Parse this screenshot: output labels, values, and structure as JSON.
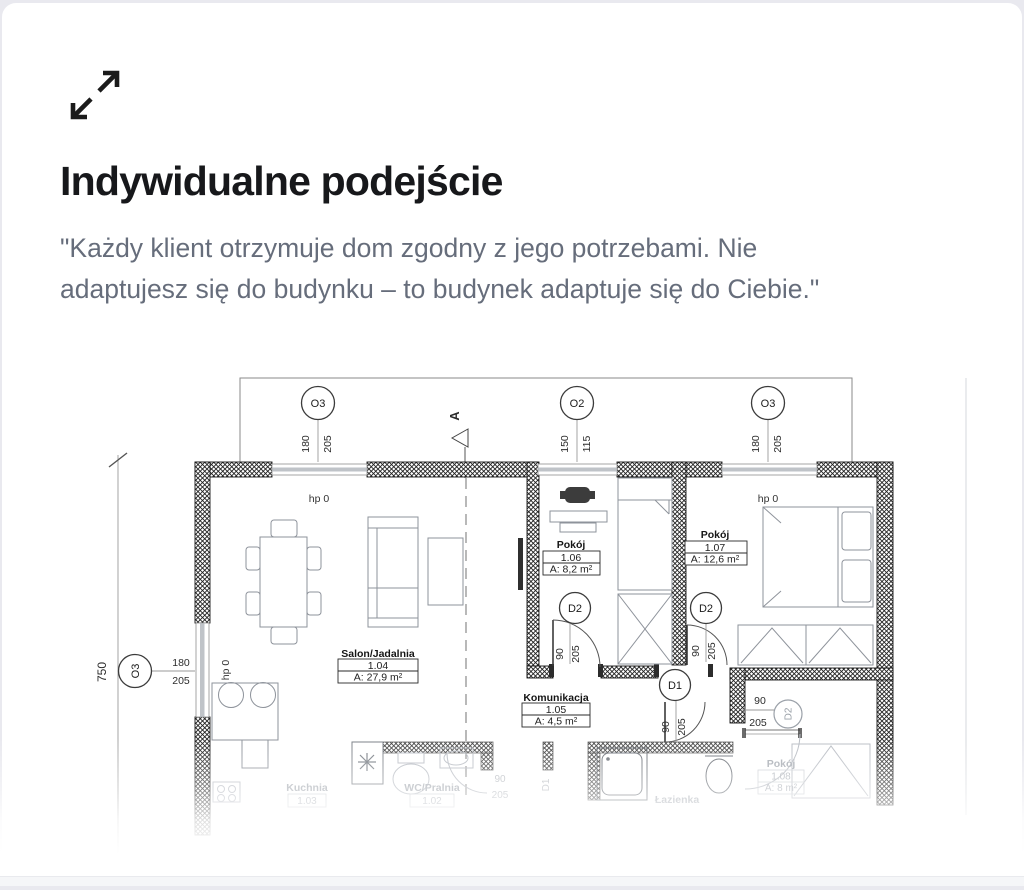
{
  "header": {
    "icon": "expand-diagonal-arrows",
    "title": "Indywidualne podejście",
    "quote": "\"Każdy klient otrzymuje dom zgodny z jego potrzebami. Nie adaptujesz się do budynku – to budynek adaptuje się do Ciebie.\""
  },
  "floorplan": {
    "section_marker": "A",
    "level_marker": "hp 0",
    "overall_height_dim": "750",
    "axis_markers": {
      "o3": "O3",
      "o2": "O2"
    },
    "door_markers": {
      "d1": "D1",
      "d2": "D2"
    },
    "window_dims": {
      "w180": "180",
      "w205": "205",
      "w150": "150",
      "w115": "115"
    },
    "door_dims": {
      "w90": "90",
      "h205": "205"
    },
    "rooms": {
      "salon": {
        "name": "Salon/Jadalnia",
        "number": "1.04",
        "area": "A: 27,9 m²"
      },
      "pokoj106": {
        "name": "Pokój",
        "number": "1.06",
        "area": "A: 8,2 m²"
      },
      "pokoj107": {
        "name": "Pokój",
        "number": "1.07",
        "area": "A: 12,6 m²"
      },
      "komunikacja": {
        "name": "Komunikacja",
        "number": "1.05",
        "area": "A: 4,5 m²"
      },
      "kuchnia": {
        "name": "Kuchnia",
        "number": "1.03"
      },
      "wc": {
        "name": "WC/Pralnia",
        "number": "1.02"
      },
      "pokoj108": {
        "name": "Pokój",
        "number": "1.08",
        "area": "A: 8 m²"
      },
      "lazienka": {
        "name": "Łazienka"
      }
    }
  }
}
